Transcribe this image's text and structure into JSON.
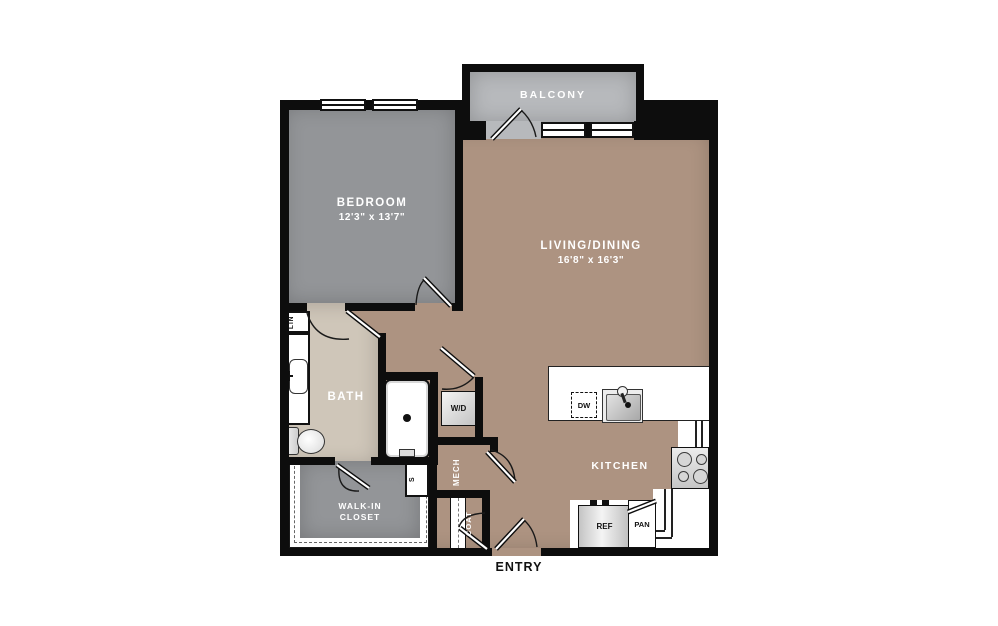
{
  "plan": {
    "balcony_label": "BALCONY",
    "bedroom_label": "BEDROOM",
    "bedroom_dims": "12'3\" x 13'7\"",
    "living_label": "LIVING/DINING",
    "living_dims": "16'8\" x 16'3\"",
    "bath_label": "BATH",
    "kitchen_label": "KITCHEN",
    "walkin_line1": "WALK-IN",
    "walkin_line2": "CLOSET",
    "mech_label": "MECH",
    "coat_label": "COAT",
    "entry_label": "ENTRY",
    "washer_dryer_label": "W/D",
    "dishwasher_label": "DW",
    "refrigerator_label": "REF",
    "pantry_label": "PAN",
    "linen_label": "LIN",
    "shelf_label": "S"
  },
  "colors": {
    "wall": "#0d0d0d",
    "bedroom_floor": "#939598",
    "balcony_floor": "#b7b9bc",
    "living_floor": "#ad9381",
    "bath_floor": "#cfc6b9",
    "closet_floor": "#939598",
    "fixture_white": "#ffffff",
    "label_light": "#ffffff",
    "label_dark": "#111111"
  }
}
